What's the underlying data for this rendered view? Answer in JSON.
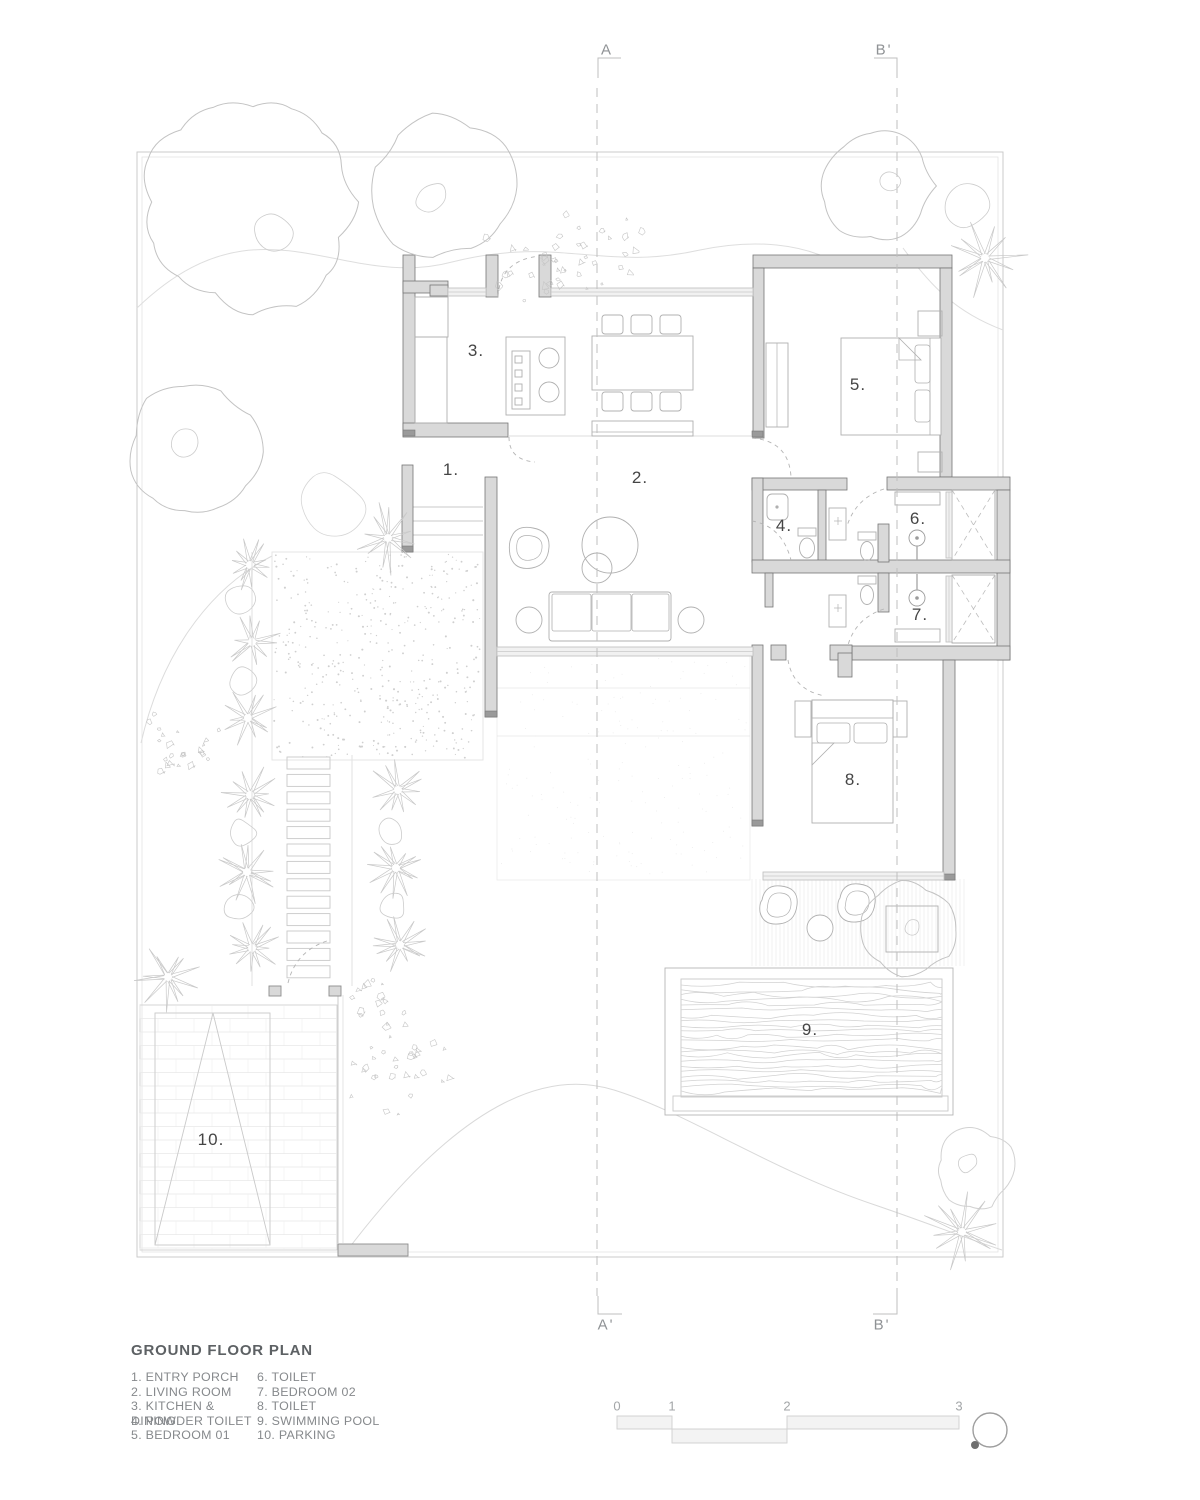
{
  "section_markers": {
    "top_left": "A",
    "top_right": "B'",
    "bottom_left": "A'",
    "bottom_right": "B'"
  },
  "room_labels": {
    "r1": "1.",
    "r2": "2.",
    "r3": "3.",
    "r4": "4.",
    "r5": "5.",
    "r6": "6.",
    "r7": "7.",
    "r8": "8.",
    "r9": "9.",
    "r10": "10."
  },
  "legend": {
    "title": "GROUND FLOOR PLAN",
    "col1": [
      "1. ENTRY PORCH",
      "2. LIVING ROOM",
      "3. KITCHEN & DINING",
      "4. POWDER TOILET",
      "5. BEDROOM 01"
    ],
    "col2": [
      "6. TOILET",
      "7. BEDROOM 02",
      "8. TOILET",
      "9. SWIMMING POOL",
      "10. PARKING"
    ]
  },
  "scale_bar": {
    "labels": [
      "0",
      "1",
      "2",
      "3"
    ]
  },
  "icons": {
    "north_arrow": "north-arrow"
  },
  "colors": {
    "wall_fill": "#d9d9d9",
    "wall_stroke": "#757575",
    "thin_line": "#c6c6c6",
    "text_gray": "#8f9295",
    "label_dark": "#454545"
  }
}
